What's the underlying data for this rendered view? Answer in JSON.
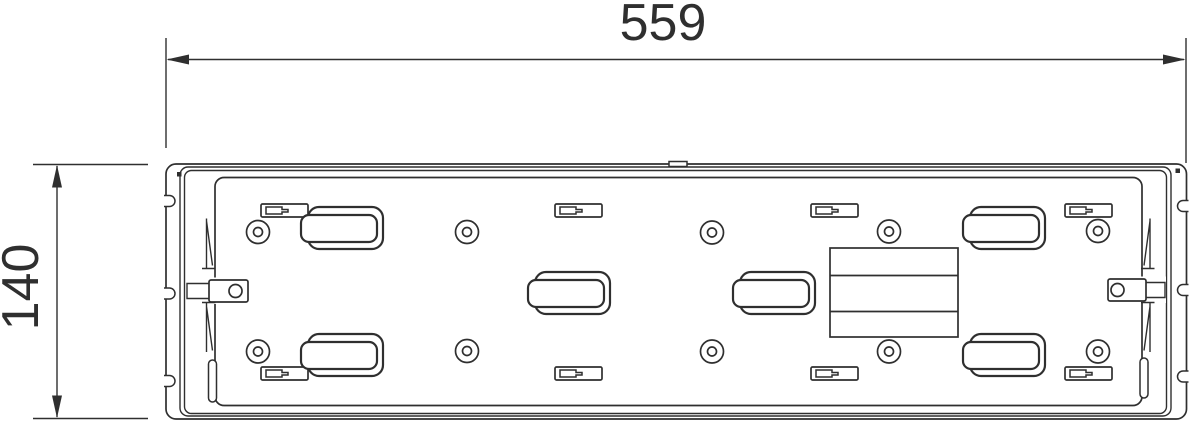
{
  "drawing": {
    "width_dimension": "559",
    "height_dimension": "140"
  },
  "colors": {
    "line": "#2f2f2f",
    "background": "#ffffff"
  }
}
